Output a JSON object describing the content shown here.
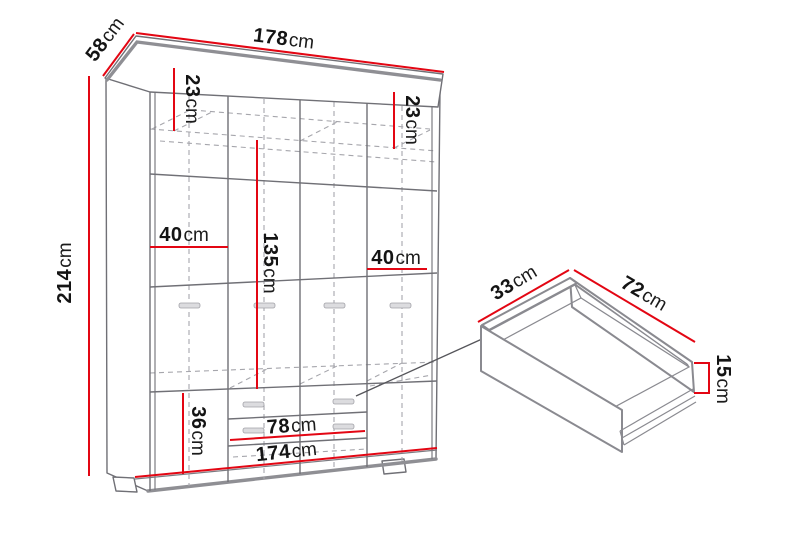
{
  "diagram": {
    "title": "wardrobe-and-drawer-dimension-diagram",
    "colors": {
      "dimension_red": "#e30613",
      "outline_gray": "#707076"
    },
    "wardrobe": {
      "width_top": {
        "value": "178",
        "unit": "cm"
      },
      "depth": {
        "value": "58",
        "unit": "cm"
      },
      "height": {
        "value": "214",
        "unit": "cm"
      },
      "top_section_left": {
        "value": "23",
        "unit": "cm"
      },
      "top_section_right": {
        "value": "23",
        "unit": "cm"
      },
      "shelf_width_left": {
        "value": "40",
        "unit": "cm"
      },
      "door_middle_height": {
        "value": "135",
        "unit": "cm"
      },
      "shelf_width_right": {
        "value": "40",
        "unit": "cm"
      },
      "bottom_section_height": {
        "value": "36",
        "unit": "cm"
      },
      "drawer_front_width": {
        "value": "78",
        "unit": "cm"
      },
      "width_bottom": {
        "value": "174",
        "unit": "cm"
      }
    },
    "drawer": {
      "inner_depth": {
        "value": "33",
        "unit": "cm"
      },
      "inner_width": {
        "value": "72",
        "unit": "cm"
      },
      "side_height": {
        "value": "15",
        "unit": "cm"
      }
    }
  }
}
